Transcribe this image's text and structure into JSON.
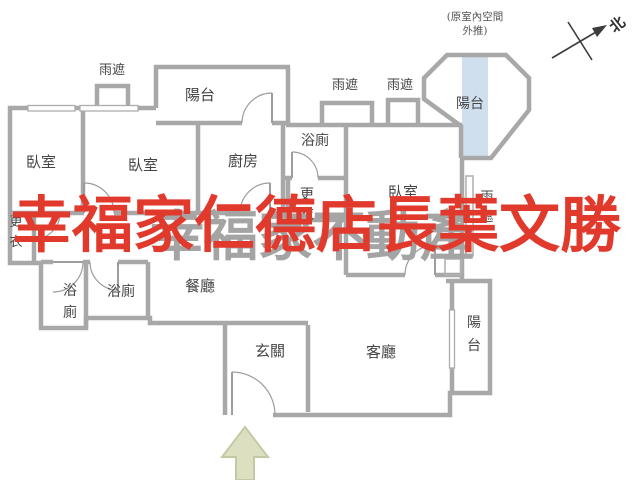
{
  "title": "apartment-floor-plan",
  "watermark": {
    "text": "幸福家仁德店長葉文勝"
  },
  "watermark_background": {
    "text": "幸福家不動產"
  },
  "annotation": {
    "line1": "(原室內空間",
    "line2": "外推)"
  },
  "compass": {
    "label": "北"
  },
  "colors": {
    "wall": "#a8a8a8",
    "label_text": "#454545",
    "red_watermark": "#e1392c",
    "gray_watermark": "#a4a4a4",
    "balcony_highlight": "#cfdfee",
    "arrow_fill": "#dce0c1",
    "arrow_stroke": "#c3c9a2"
  },
  "labels": [
    {
      "name": "room-label-bedroom-1",
      "text": "臥室",
      "x": 41,
      "y": 167,
      "size": 15,
      "vertical": false
    },
    {
      "name": "room-label-bedroom-2",
      "text": "臥室",
      "x": 143,
      "y": 170,
      "size": 15,
      "vertical": false
    },
    {
      "name": "room-label-kitchen",
      "text": "廚房",
      "x": 243,
      "y": 166,
      "size": 15,
      "vertical": false
    },
    {
      "name": "room-label-bath-top",
      "text": "浴廁",
      "x": 315,
      "y": 145,
      "size": 14,
      "vertical": false
    },
    {
      "name": "room-label-closet-center",
      "text": "更衣",
      "x": 307,
      "y": 199,
      "size": 14,
      "vertical": true,
      "lh": 20
    },
    {
      "name": "room-label-master-bedroom",
      "text": "臥室",
      "x": 403,
      "y": 197,
      "size": 15,
      "vertical": false
    },
    {
      "name": "room-label-bath-left",
      "text": "浴廁",
      "x": 70,
      "y": 295,
      "size": 14,
      "vertical": true,
      "lh": 22
    },
    {
      "name": "room-label-bath-2",
      "text": "浴廁",
      "x": 121,
      "y": 296,
      "size": 14,
      "vertical": false
    },
    {
      "name": "room-label-dining",
      "text": "餐廳",
      "x": 200,
      "y": 291,
      "size": 15,
      "vertical": false
    },
    {
      "name": "room-label-entry",
      "text": "玄關",
      "x": 270,
      "y": 356,
      "size": 15,
      "vertical": false
    },
    {
      "name": "room-label-living",
      "text": "客廳",
      "x": 381,
      "y": 357,
      "size": 15,
      "vertical": false
    },
    {
      "name": "room-label-balcony-top",
      "text": "陽台",
      "x": 200,
      "y": 100,
      "size": 15,
      "vertical": false
    },
    {
      "name": "room-label-balcony-octagon",
      "text": "陽台",
      "x": 470,
      "y": 108,
      "size": 14,
      "vertical": false
    },
    {
      "name": "room-label-balcony-right",
      "text": "陽台",
      "x": 474,
      "y": 327,
      "size": 14,
      "vertical": true,
      "lh": 23
    },
    {
      "name": "label-rain-shield-top-left",
      "text": "雨遮",
      "x": 112,
      "y": 74,
      "size": 13,
      "vertical": false
    },
    {
      "name": "label-rain-shield-mid-1",
      "text": "雨遮",
      "x": 345,
      "y": 89,
      "size": 13,
      "vertical": false
    },
    {
      "name": "label-rain-shield-mid-2",
      "text": "雨遮",
      "x": 400,
      "y": 89,
      "size": 13,
      "vertical": false
    },
    {
      "name": "label-rain-shield-right",
      "text": "雨遮",
      "x": 487,
      "y": 201,
      "size": 13,
      "vertical": true,
      "lh": 20
    },
    {
      "name": "room-label-closet-left",
      "text": "更衣",
      "x": 16,
      "y": 226,
      "size": 13,
      "vertical": true,
      "lh": 20
    }
  ]
}
